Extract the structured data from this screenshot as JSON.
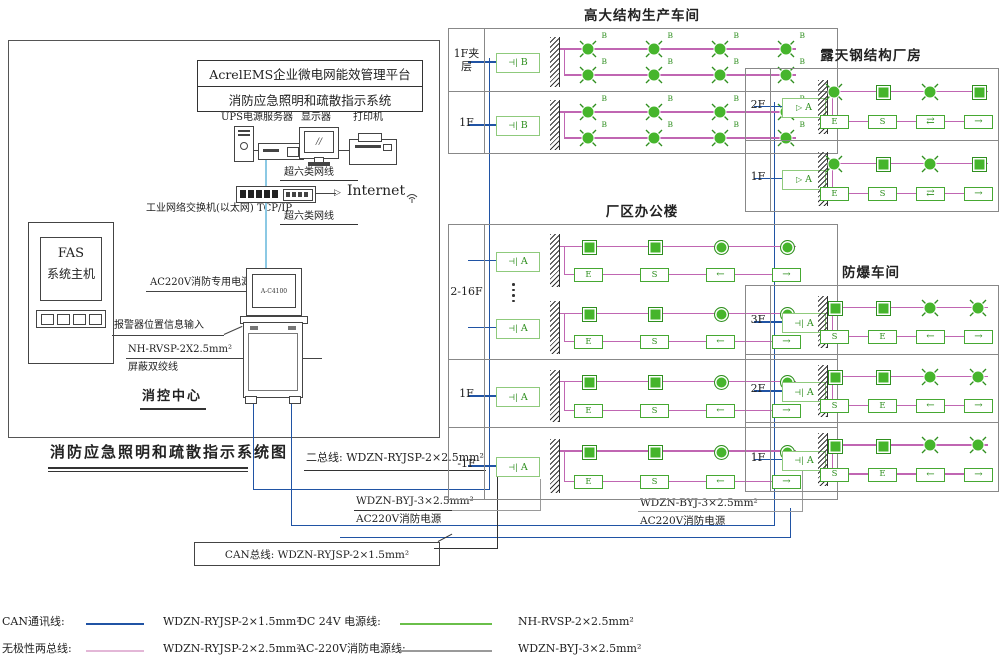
{
  "page_title": "消防应急照明和疏散指示系统图",
  "platform": {
    "line1": "AcrelEMS企业微电网能效管理平台",
    "line2": "消防应急照明和疏散指示系统"
  },
  "cc": {
    "ups": "UPS电源",
    "server": "服务器",
    "display": "显示器",
    "printer": "打印机",
    "cat6_top": "超六类网线",
    "cat6_bottom": "超六类网线",
    "switch": "工业网络交换机(以太网) TCP/IP",
    "internet": "Internet",
    "fas1": "FAS",
    "fas2": "系统主机",
    "ac220": "AC220V消防专用电源",
    "alarm": "报警器位置信息输入",
    "cable": "NH-RVSP-2X2.5mm²",
    "cable_note": "屏蔽双绞线",
    "room": "消控中心",
    "screen": "A-C4100"
  },
  "bus": {
    "two_bus": "二总线: WDZN-RYJSP-2×2.5mm²",
    "pwr_mid_1": "WDZN-BYJ-3×2.5mm²",
    "pwr_mid_2": "AC220V消防电源",
    "pwr_right_1": "WDZN-BYJ-3×2.5mm²",
    "pwr_right_2": "AC220V消防电源",
    "can": "CAN总线: WDZN-RYJSP-2×1.5mm²"
  },
  "sections": [
    {
      "id": "tall",
      "title": "高大结构生产车间",
      "controller": {
        "glyph": "bars",
        "label": "B"
      },
      "floors": [
        {
          "label": "1F夹层",
          "groups": [
            {
              "top": [
                "x",
                "x",
                "x",
                "x"
              ],
              "bottom": [
                "x",
                "x",
                "x",
                "x"
              ],
              "tag": "B"
            }
          ]
        },
        {
          "label": "1F",
          "groups": [
            {
              "top": [
                "x",
                "x",
                "x",
                "x"
              ],
              "bottom": [
                "x",
                "x",
                "x",
                "x"
              ],
              "tag": "B"
            }
          ]
        }
      ]
    },
    {
      "id": "office",
      "title": "厂区办公楼",
      "controller": {
        "glyph": "bars",
        "label": "A"
      },
      "floors": [
        {
          "label": "2-16F",
          "dots": true,
          "groups": [
            {
              "top": [
                "sq",
                "sq",
                "c",
                "c"
              ],
              "bottom": [
                "E",
                "S",
                "←",
                "→"
              ],
              "tag": ""
            },
            {
              "top": [
                "sq",
                "sq",
                "c",
                "c"
              ],
              "bottom": [
                "E",
                "S",
                "←",
                "→"
              ],
              "tag": ""
            }
          ]
        },
        {
          "label": "1F",
          "groups": [
            {
              "top": [
                "sq",
                "sq",
                "c",
                "c"
              ],
              "bottom": [
                "E",
                "S",
                "←",
                "→"
              ],
              "tag": ""
            }
          ]
        },
        {
          "label": "-1F",
          "groups": [
            {
              "top": [
                "sq",
                "sq",
                "c",
                "c"
              ],
              "bottom": [
                "E",
                "S",
                "←",
                "→"
              ],
              "tag": ""
            }
          ]
        }
      ]
    },
    {
      "id": "steel",
      "title": "露天钢结构厂房",
      "controller": {
        "glyph": "tri",
        "label": "A"
      },
      "floors": [
        {
          "label": "2F",
          "groups": [
            {
              "top": [
                "x",
                "sq",
                "x",
                "sq"
              ],
              "bottom": [
                "E",
                "S",
                "⇄",
                "→"
              ],
              "tag": ""
            }
          ]
        },
        {
          "label": "1F",
          "groups": [
            {
              "top": [
                "x",
                "sq",
                "x",
                "sq"
              ],
              "bottom": [
                "E",
                "S",
                "⇄",
                "→"
              ],
              "tag": ""
            }
          ]
        }
      ]
    },
    {
      "id": "exproof",
      "title": "防爆车间",
      "controller": {
        "glyph": "bars",
        "label": "A"
      },
      "floors": [
        {
          "label": "3F",
          "groups": [
            {
              "top": [
                "sq",
                "sq",
                "x",
                "x"
              ],
              "bottom": [
                "S",
                "E",
                "←",
                "→"
              ],
              "tag": ""
            }
          ]
        },
        {
          "label": "2F",
          "groups": [
            {
              "top": [
                "sq",
                "sq",
                "x",
                "x"
              ],
              "bottom": [
                "S",
                "E",
                "←",
                "→"
              ],
              "tag": ""
            }
          ]
        },
        {
          "label": "1F",
          "groups": [
            {
              "top": [
                "sq",
                "sq",
                "x",
                "x"
              ],
              "bottom": [
                "S",
                "E",
                "←",
                "→"
              ],
              "tag": ""
            }
          ]
        }
      ]
    }
  ],
  "legend": {
    "rows": [
      {
        "items": [
          {
            "label": "CAN通讯线:",
            "color": "#2053a4",
            "spec": "WDZN-RYJSP-2×1.5mm²"
          },
          {
            "label": "DC 24V 电源线:",
            "color": "#6abf4a",
            "spec": "NH-RVSP-2×2.5mm²"
          }
        ]
      },
      {
        "items": [
          {
            "label": "无极性两总线:",
            "color": "#e3b7d7",
            "spec": "WDZN-RYJSP-2×2.5mm²"
          },
          {
            "label": "AC-220V消防电源线:",
            "color": "#9a9a9a",
            "spec": "WDZN-BYJ-3×2.5mm²"
          }
        ]
      }
    ]
  },
  "colors": {
    "can_blue": "#2053a4",
    "two_bus_pink": "#c066b2",
    "dc24_green": "#6abf4a",
    "ac220_gray": "#9a9a9a",
    "device_green": "#46b52c",
    "cat6_cyan": "#8cc9e4"
  }
}
